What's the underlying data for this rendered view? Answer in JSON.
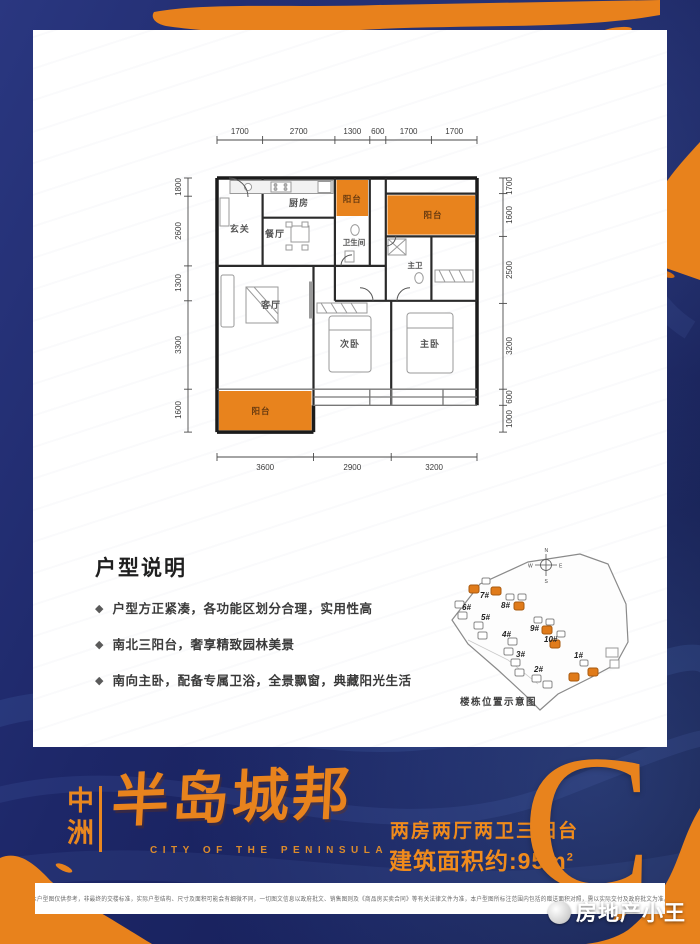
{
  "theme": {
    "navy": "#1d2768",
    "orange": "#e8831d",
    "card_white": "#ffffff"
  },
  "floorplan": {
    "dims_top": [
      "1700",
      "2700",
      "1300",
      "600",
      "1700",
      "1700"
    ],
    "dims_left": [
      "1800",
      "2600",
      "1300",
      "3300",
      "1600"
    ],
    "dims_right": [
      "1700",
      "1600",
      "2500",
      "3200",
      "600",
      "1000"
    ],
    "dims_bottom": [
      "3600",
      "2900",
      "3200"
    ],
    "rooms": {
      "entry": "玄关",
      "kitchen": "厨房",
      "balcony_top": "阳台",
      "dining": "餐厅",
      "bath": "卫生间",
      "balcony_right": "阳台",
      "master_bath": "主卫",
      "living": "客厅",
      "bedroom2": "次卧",
      "master": "主卧",
      "balcony_bottom": "阳台"
    }
  },
  "description": {
    "title": "户型说明",
    "bullet_icon": "◆",
    "bullets": [
      "户型方正紧凑，各功能区划分合理，实用性高",
      "南北三阳台，奢享精致园林美景",
      "南向主卧，配备专属卫浴，全景飘窗，典藏阳光生活"
    ]
  },
  "sitemap": {
    "caption": "楼栋位置示意图",
    "compass": {
      "n": "N",
      "e": "E",
      "s": "S",
      "w": "W"
    },
    "buildings": [
      {
        "label": "6#",
        "highlighted": false
      },
      {
        "label": "7#",
        "highlighted": true
      },
      {
        "label": "8#",
        "highlighted": true
      },
      {
        "label": "5#",
        "highlighted": false
      },
      {
        "label": "9#",
        "highlighted": true
      },
      {
        "label": "4#",
        "highlighted": false
      },
      {
        "label": "10#",
        "highlighted": true
      },
      {
        "label": "3#",
        "highlighted": false
      },
      {
        "label": "2#",
        "highlighted": false
      },
      {
        "label": "1#",
        "highlighted": true
      }
    ]
  },
  "brand": {
    "name_vertical": "中洲",
    "name_main": "半岛城邦",
    "name_en": "CITY OF THE PENINSULA"
  },
  "unit": {
    "rooms_desc": "两房两厅两卫三阳台",
    "area_prefix": "建筑面积约:95m",
    "area_sup": "2",
    "type_letter": "C"
  },
  "footer": {
    "disclaimer": "本户型图仅供参考，非最终的交楼标准，实际户型结构、尺寸及面积可能会有细微不同，一切图文信息以政府批文、销售图则及《商品房买卖合同》等有关法律文件为准，本户型图所标注范围内包括的赠送面积对照，需以实际交付及政府批文为准。",
    "watermark": "房地产小王"
  }
}
